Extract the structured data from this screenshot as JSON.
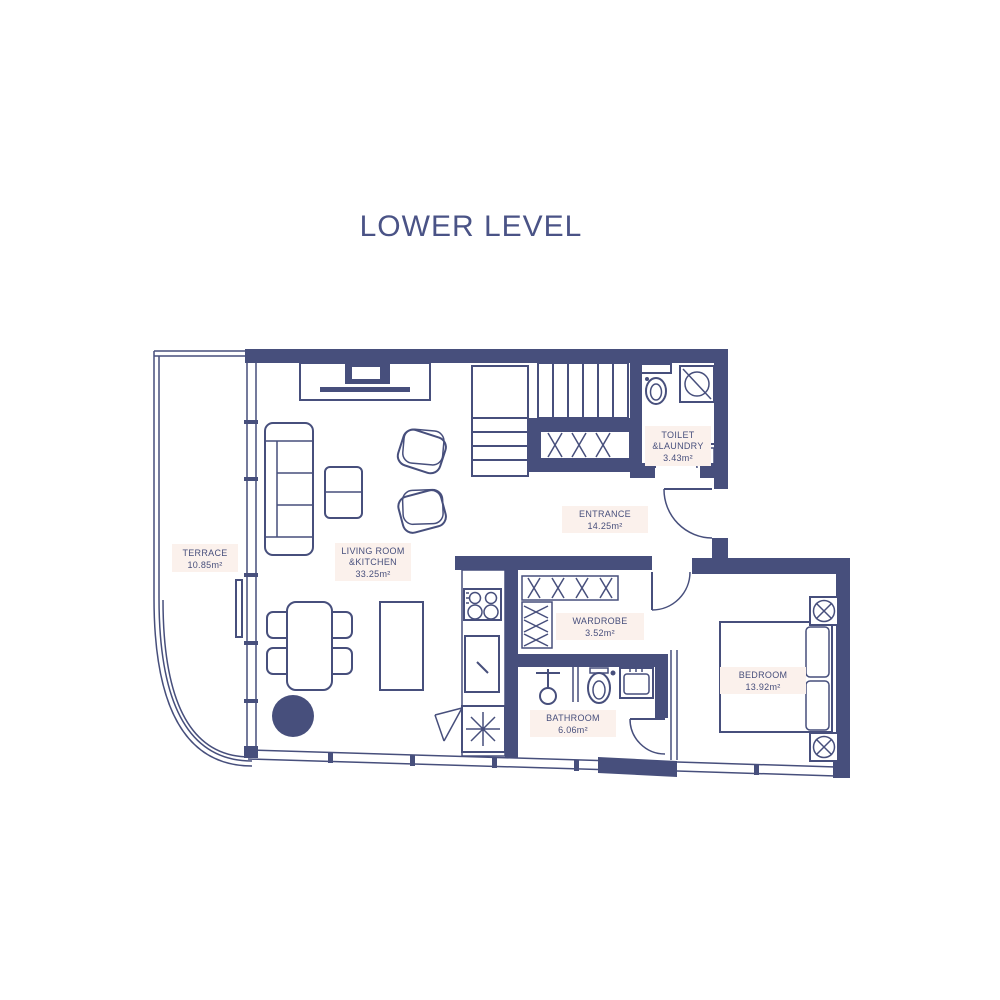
{
  "title": "LOWER LEVEL",
  "colors": {
    "background": "#ffffff",
    "wall": "#474f7c",
    "text": "#474f7c",
    "title_text": "#4a5386",
    "label_background": "#fbf1ec"
  },
  "rooms": {
    "terrace": {
      "name": "TERRACE",
      "area": "10.85m²"
    },
    "living": {
      "name_line1": "LIVING ROOM",
      "name_line2": "&KITCHEN",
      "area": "33.25m²"
    },
    "entrance": {
      "name": "ENTRANCE",
      "area": "14.25m²"
    },
    "toilet_laundry": {
      "name_line1": "TOILET",
      "name_line2": "&LAUNDRY",
      "area": "3.43m²"
    },
    "wardrobe": {
      "name": "WARDROBE",
      "area": "3.52m²"
    },
    "bathroom": {
      "name": "BATHROOM",
      "area": "6.06m²"
    },
    "bedroom": {
      "name": "BEDROOM",
      "area": "13.92m²"
    }
  }
}
